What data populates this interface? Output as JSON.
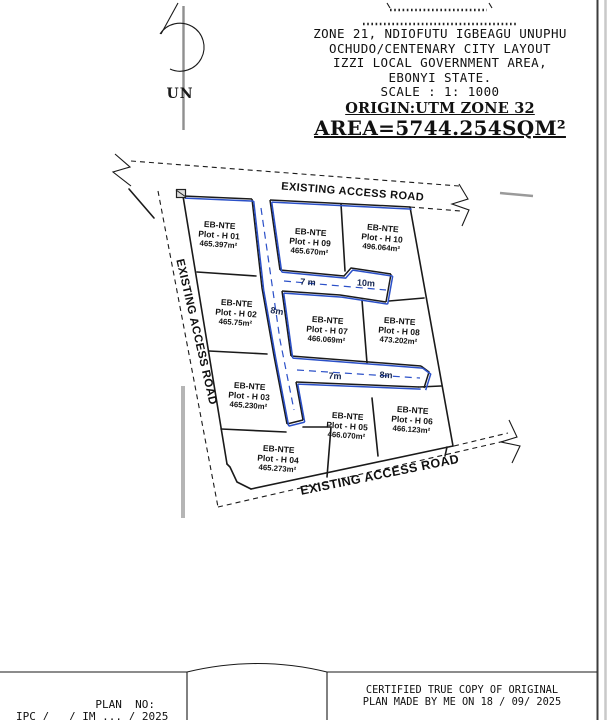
{
  "colors": {
    "road_blue": "#2b50c8",
    "ink": "#1a1a1a",
    "muted_gray": "#9a9a9a"
  },
  "header": {
    "title_line1": "ZONE 21, NDIOFUTU IGBEAGU UNUPHU",
    "title_line2": "OCHUDO/CENTENARY CITY LAYOUT",
    "title_line3": "IZZI LOCAL GOVERNMENT AREA,",
    "title_line4": "EBONYI STATE.",
    "scale": "SCALE : 1: 1000",
    "origin": "ORIGIN:UTM ZONE 32",
    "area": "AREA=5744.254SQM²"
  },
  "north_arrow": {
    "label": "UN"
  },
  "plan": {
    "road_labels": {
      "top": "EXISTING ACCESS ROAD",
      "left": "EXISTING ACCESS ROAD",
      "bottom": "EXISTING ACCESS ROAD"
    },
    "dimensions": [
      "7 m",
      "10m",
      "8m",
      "7m",
      "8m"
    ],
    "plots": [
      {
        "name": "EB-NTE",
        "plot": "Plot - H 01",
        "area": "465.397m²"
      },
      {
        "name": "EB-NTE",
        "plot": "Plot - H 02",
        "area": "465.75m²"
      },
      {
        "name": "EB-NTE",
        "plot": "Plot - H 03",
        "area": "465.230m²"
      },
      {
        "name": "EB-NTE",
        "plot": "Plot - H 04",
        "area": "465.273m²"
      },
      {
        "name": "EB-NTE",
        "plot": "Plot - H 05",
        "area": "466.070m²"
      },
      {
        "name": "EB-NTE",
        "plot": "Plot - H 06",
        "area": "466.123m²"
      },
      {
        "name": "EB-NTE",
        "plot": "Plot - H 07",
        "area": "466.069m²"
      },
      {
        "name": "EB-NTE",
        "plot": "Plot - H 08",
        "area": "473.202m²"
      },
      {
        "name": "EB-NTE",
        "plot": "Plot - H 09",
        "area": "465.670m²"
      },
      {
        "name": "EB-NTE",
        "plot": "Plot - H 10",
        "area": "496.064m²"
      }
    ]
  },
  "footer": {
    "plan_no_label": "PLAN  NO:",
    "plan_no_value": "IPC /   / IM ... / 2025",
    "certified_line1": "CERTIFIED TRUE COPY OF ORIGINAL",
    "certified_line2": "PLAN MADE BY ME ON 18 / 09/ 2025"
  }
}
